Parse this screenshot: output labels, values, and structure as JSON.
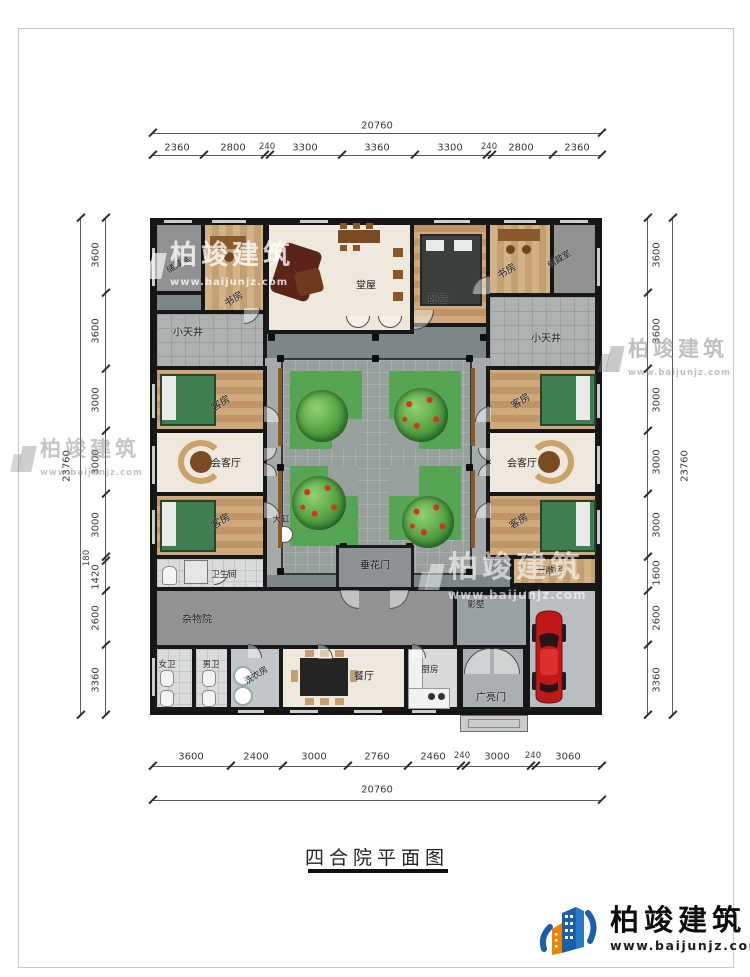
{
  "title": "四合院平面图",
  "brand": {
    "name": "柏竣建筑",
    "url": "www.baijunjz.com"
  },
  "dims": {
    "top": {
      "total": "20760",
      "segments": [
        "2360",
        "2800",
        "240",
        "3300",
        "3360",
        "3300",
        "240",
        "2800",
        "2360"
      ]
    },
    "bottom": {
      "total": "20760",
      "segments": [
        "3600",
        "2400",
        "3000",
        "2760",
        "2460",
        "240",
        "3000",
        "240",
        "3060"
      ]
    },
    "left": {
      "total": "23760",
      "segments": [
        "3600",
        "3600",
        "3000",
        "3000",
        "3000",
        "180",
        "1420",
        "2600",
        "3360"
      ]
    },
    "right": {
      "total": "23760",
      "segments": [
        "3600",
        "3600",
        "3000",
        "3000",
        "3000",
        "1600",
        "2600",
        "3360"
      ]
    }
  },
  "rooms": {
    "storage": "储藏室",
    "study": "书房",
    "hall": "堂屋",
    "bedroom": "卧室",
    "light_well": "小天井",
    "guest_room": "客房",
    "reception": "会客厅",
    "festoon_gate": "垂花门",
    "vat": "大缸",
    "bathroom": "卫生间",
    "utility_yard": "杂物院",
    "womens_wc": "女卫",
    "mens_wc": "男卫",
    "laundry": "洗衣房",
    "dining": "餐厅",
    "kitchen": "厨房",
    "screen_wall": "影壁",
    "gate": "广亮门",
    "open_room": "开敞房"
  },
  "colors": {
    "accent_blue": "#1a5fa8",
    "accent_orange": "#f08300",
    "plot_green": "#55a554",
    "car_red": "#c01818"
  }
}
